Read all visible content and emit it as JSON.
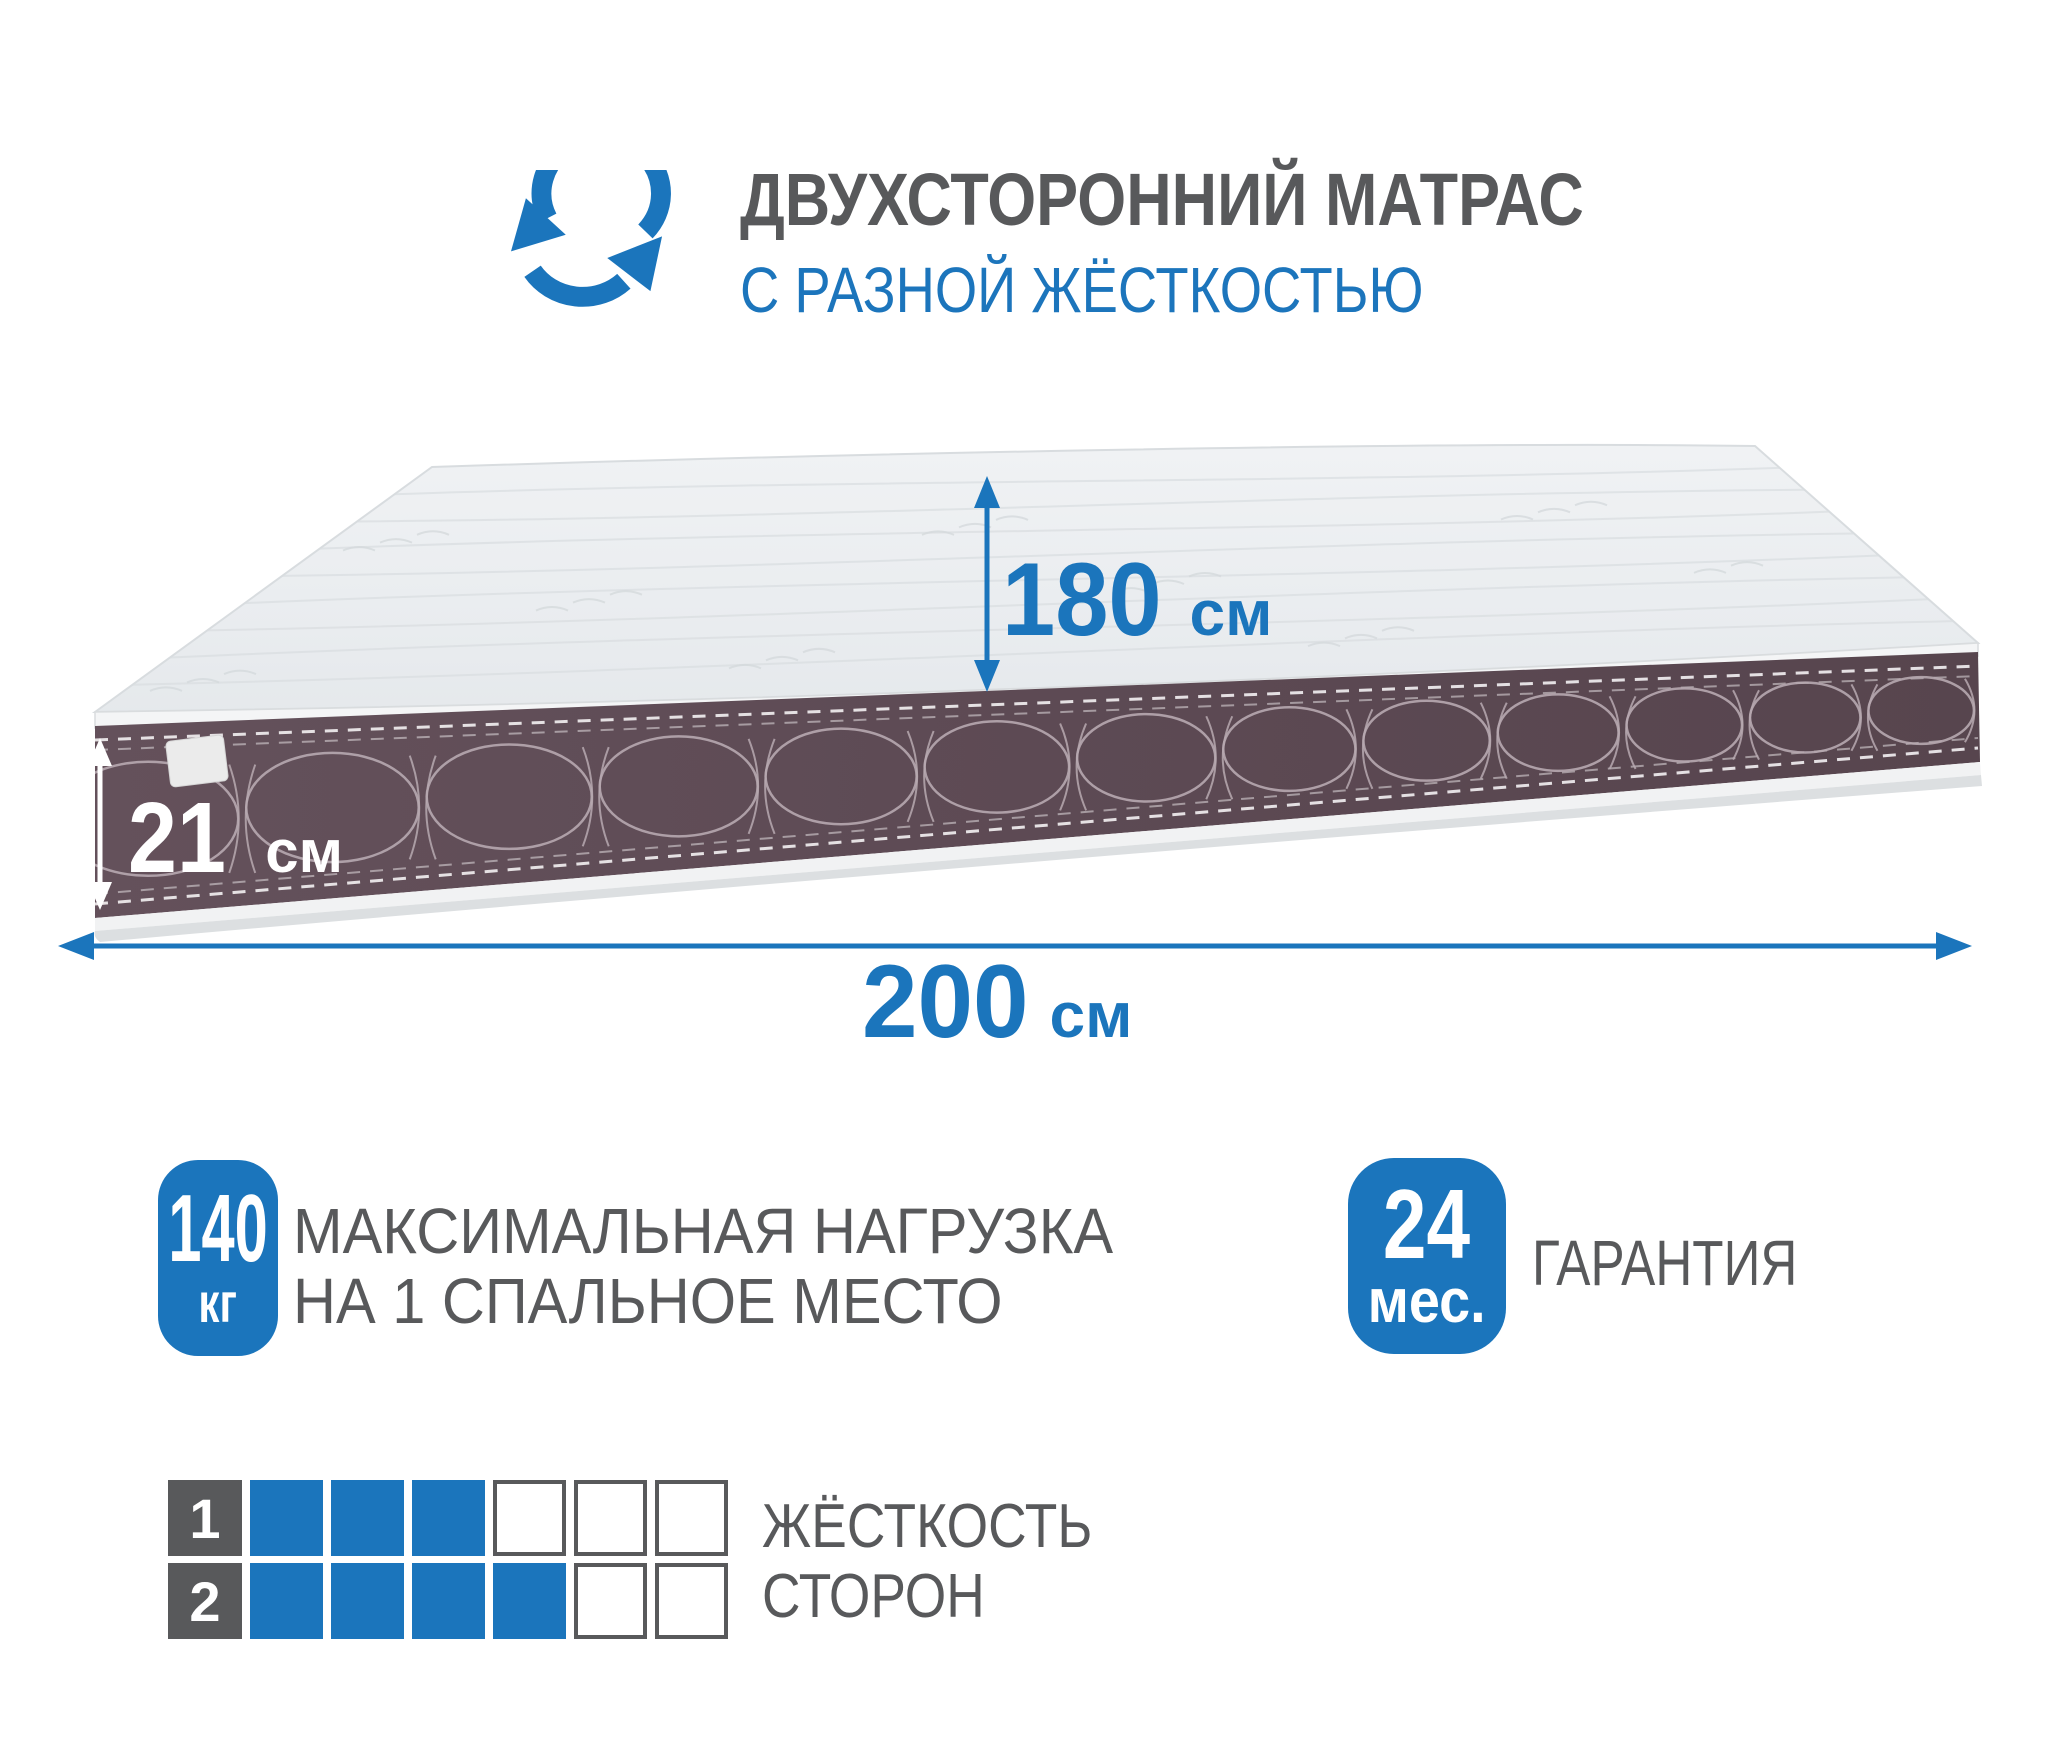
{
  "header": {
    "icon": "rotate-arrows-icon",
    "title": "ДВУХСТОРОННИЙ МАТРАС",
    "subtitle": "С РАЗНОЙ ЖЁСТКОСТЬЮ"
  },
  "dimensions": {
    "width": {
      "value": "180",
      "unit": "см"
    },
    "thickness": {
      "value": "21",
      "unit": "см"
    },
    "length": {
      "value": "200",
      "unit": "см"
    }
  },
  "badges": {
    "max_load": {
      "value": "140",
      "unit": "кг",
      "label_line1": "МАКСИМАЛЬНАЯ НАГРУЗКА",
      "label_line2": "НА 1 СПАЛЬНОЕ МЕСТО"
    },
    "warranty": {
      "value": "24",
      "unit": "мес.",
      "label": "ГАРАНТИЯ"
    }
  },
  "firmness": {
    "label_line1": "ЖЁСТКОСТЬ",
    "label_line2": "СТОРОН",
    "scale_max": 6,
    "sides": [
      {
        "label": "1",
        "filled": 3
      },
      {
        "label": "2",
        "filled": 4
      }
    ]
  },
  "colors": {
    "accent": "#1B75BC",
    "text_gray": "#58595B",
    "mattress_side": "#5D4A54",
    "mattress_top": "#E9ECEF"
  }
}
